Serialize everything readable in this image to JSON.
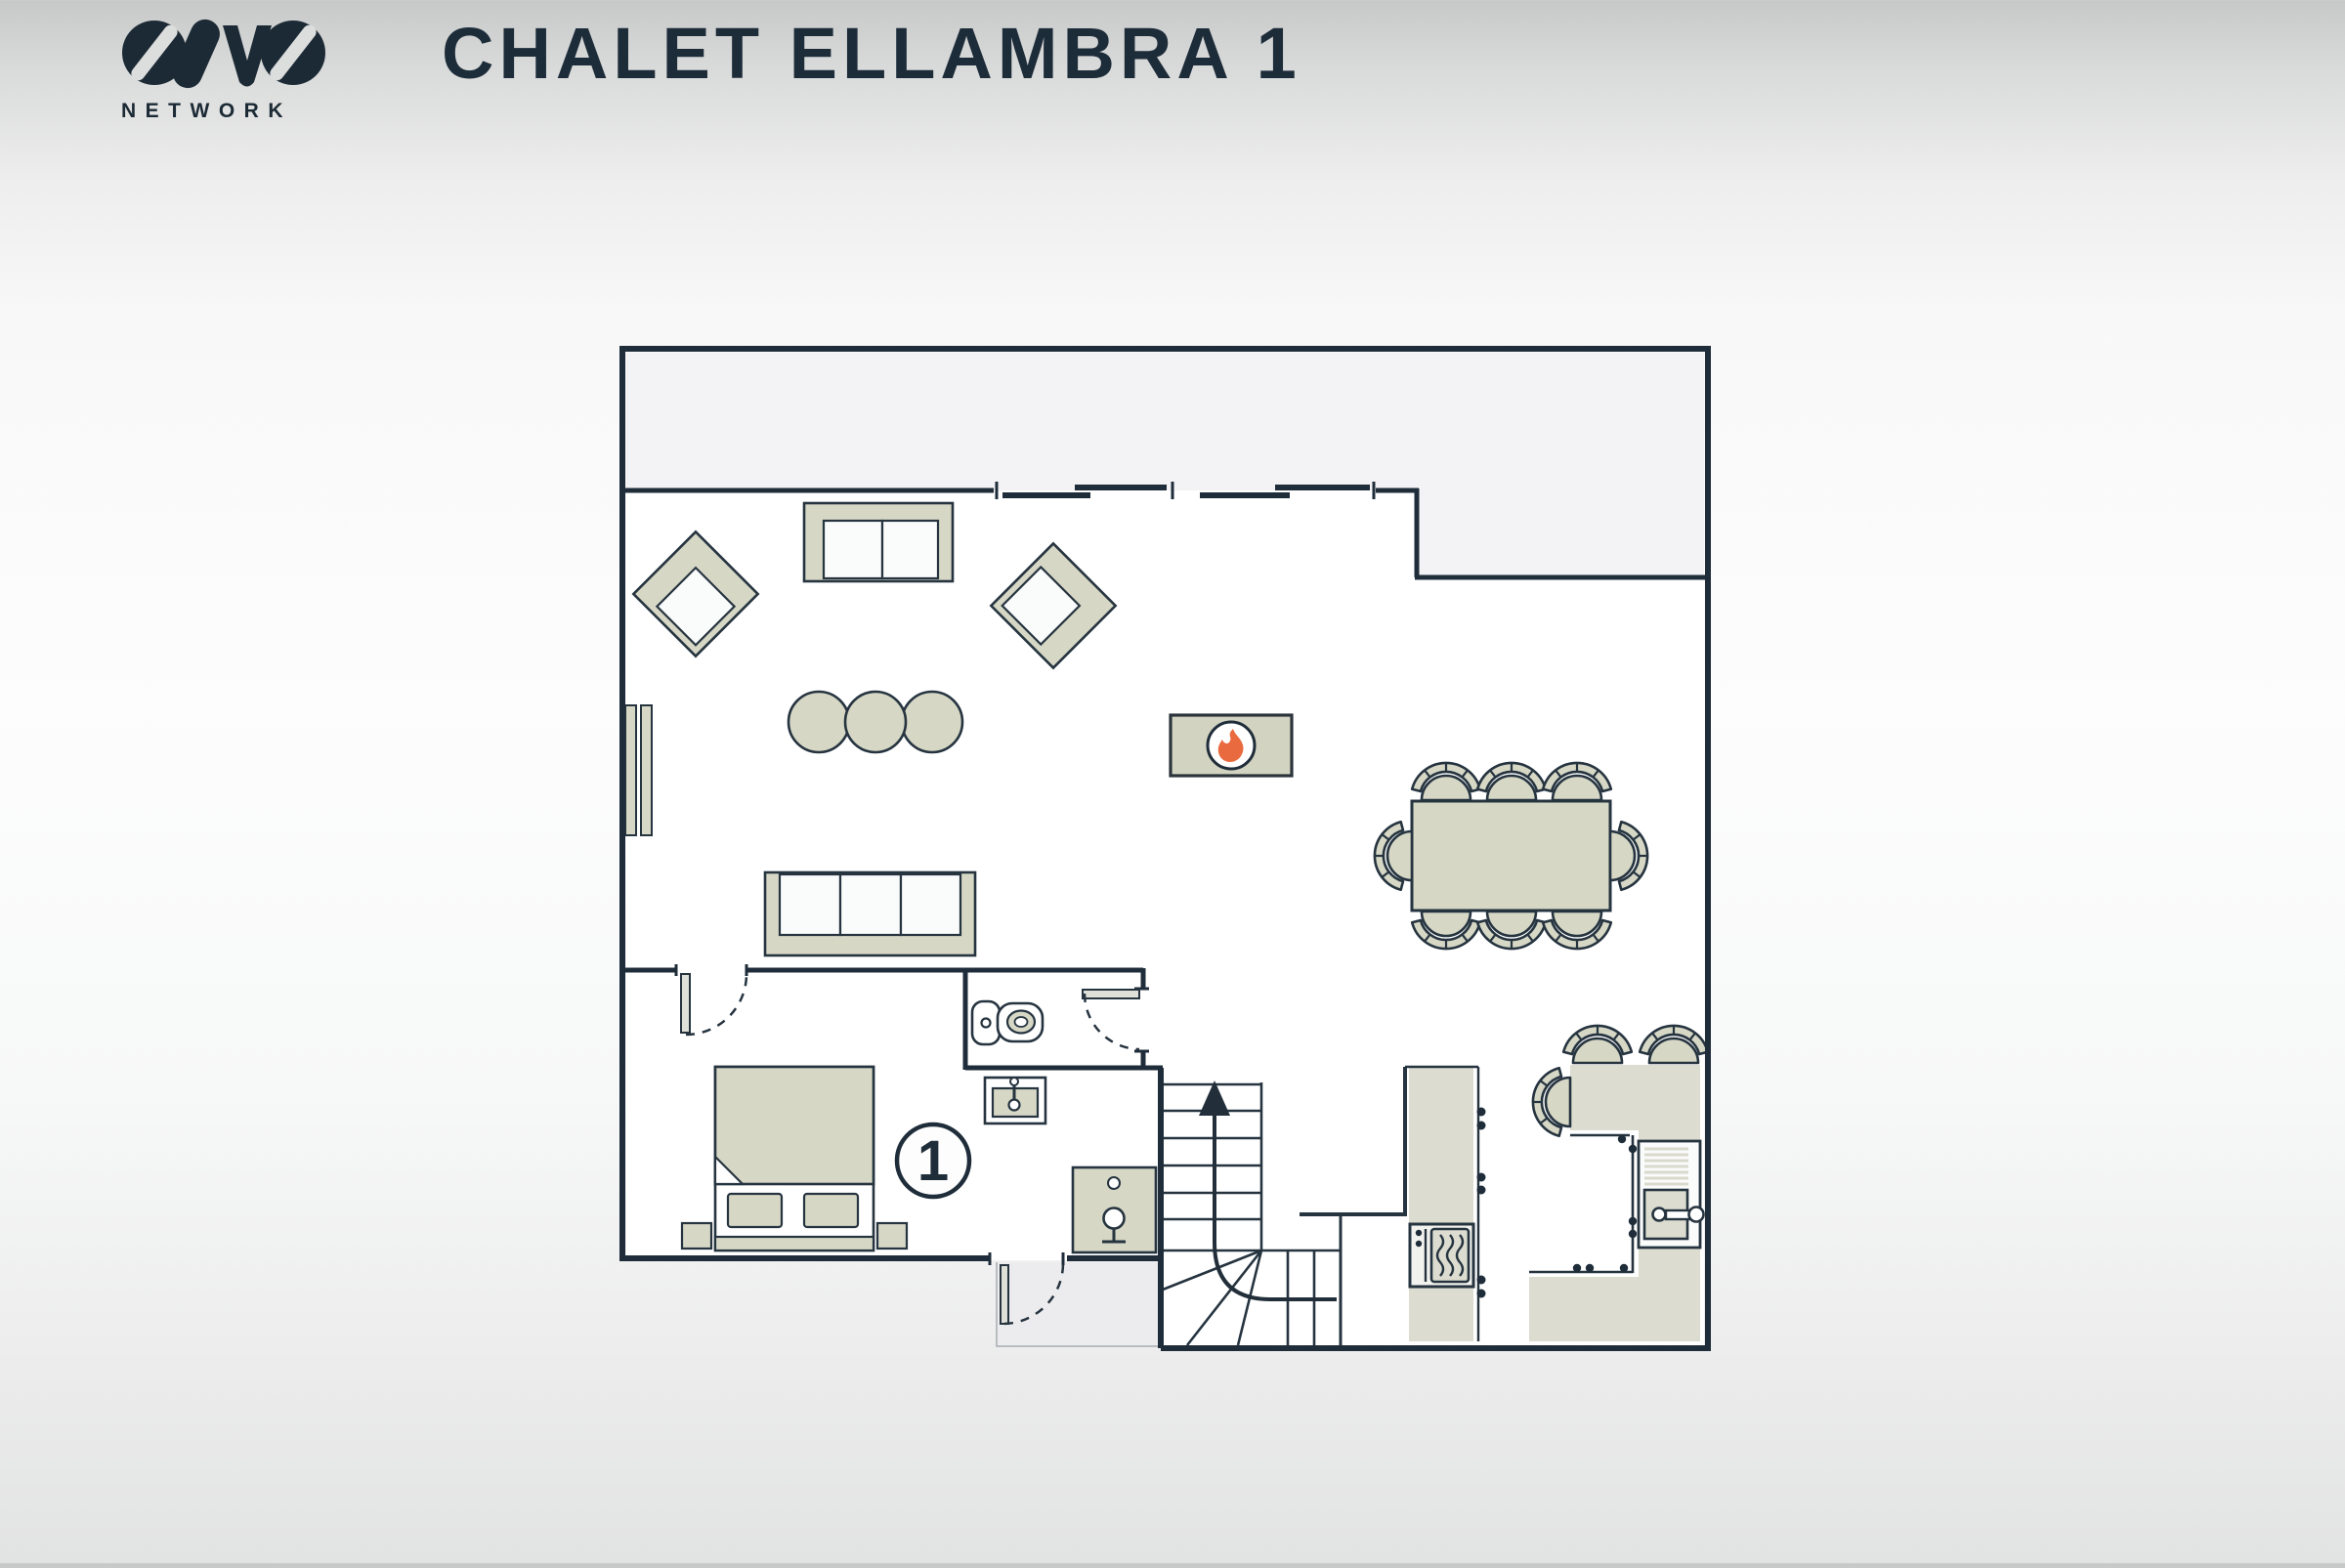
{
  "header": {
    "logo": {
      "brand": "OVO",
      "subtitle": "NETWORK"
    },
    "title": "CHALET ELLAMBRA 1"
  },
  "floor_plan": {
    "unit_badge": "1",
    "icons": [
      {
        "name": "fireplace-flame-icon",
        "color": "#e96a3f"
      },
      {
        "name": "stairs-up-arrow-icon",
        "color": "#222f3b"
      },
      {
        "name": "sliding-door-icon"
      },
      {
        "name": "hinged-door-icon"
      },
      {
        "name": "toilet-icon"
      },
      {
        "name": "vanity-sink-icon"
      },
      {
        "name": "shower-icon"
      },
      {
        "name": "oven-icon"
      },
      {
        "name": "kitchen-sink-icon"
      },
      {
        "name": "radiator-icon"
      }
    ],
    "colors": {
      "wall": "#1f2d3a",
      "furniture_fill": "#d6d7c5",
      "balcony_fill": "#f3f3f5",
      "interior_fill": "#ffffff",
      "flame": "#e96a3f",
      "title_text": "#1d2c39"
    }
  }
}
